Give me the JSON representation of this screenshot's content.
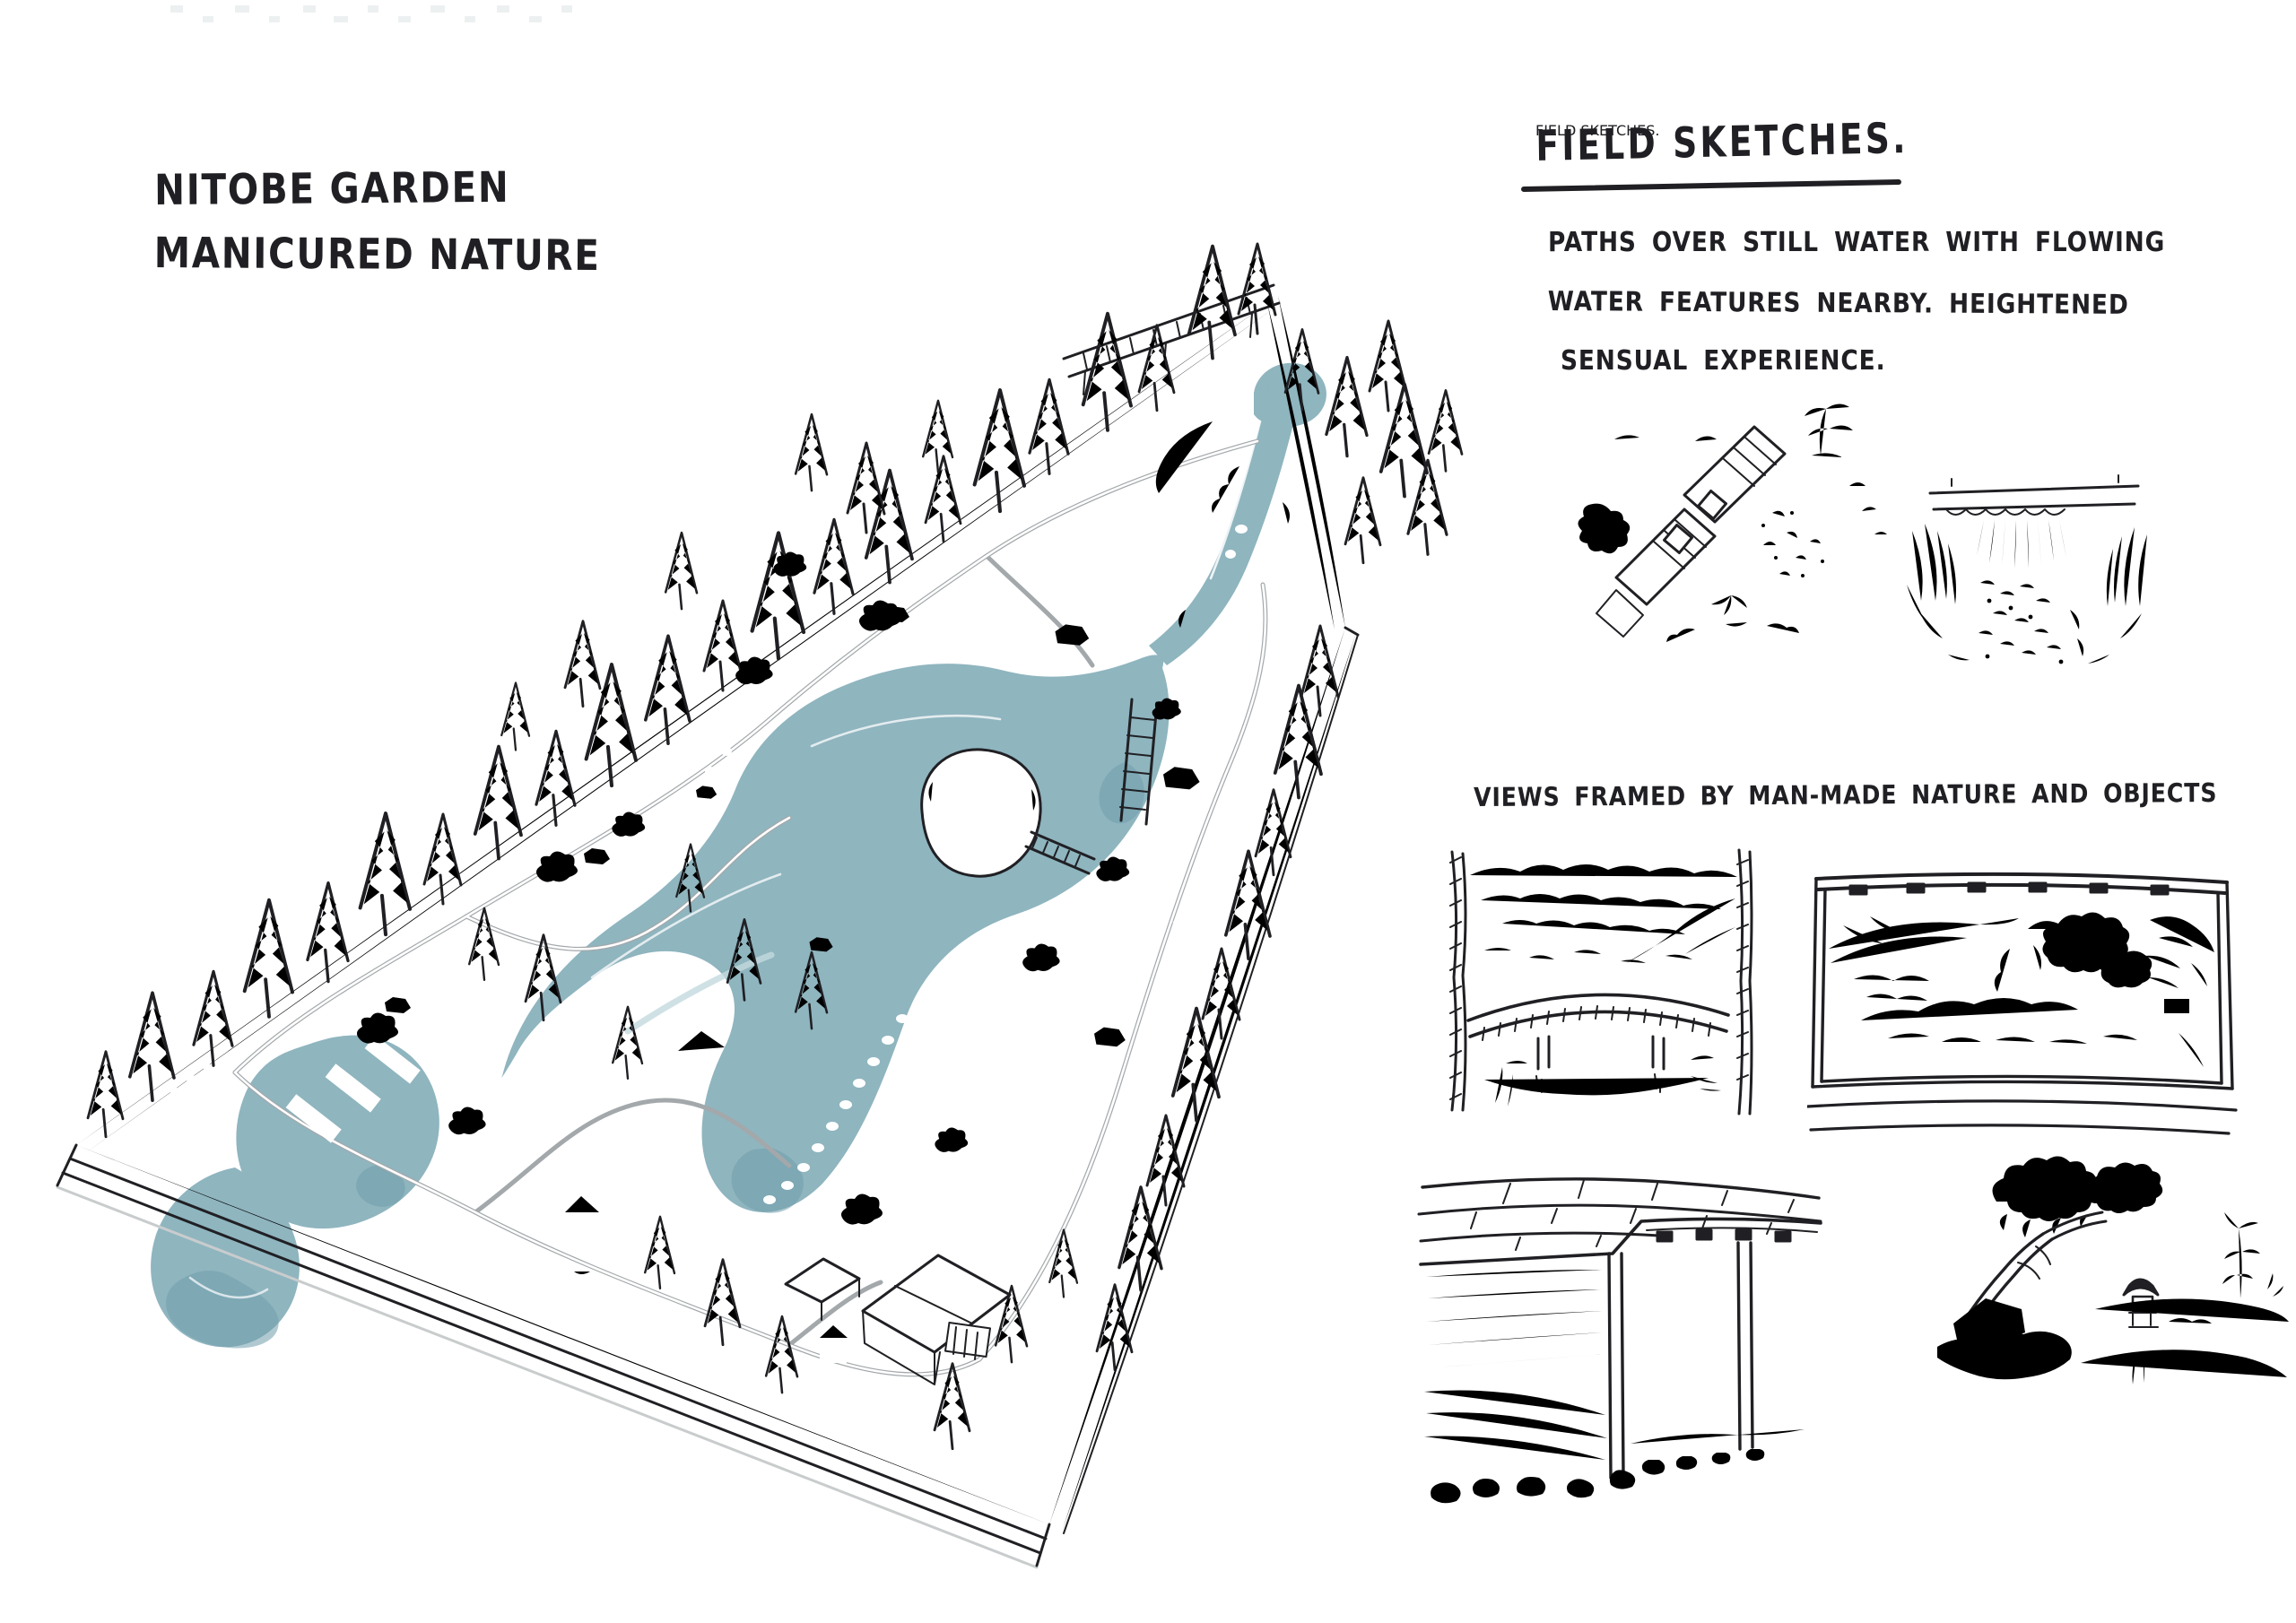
{
  "colors": {
    "paper": "#ffffff",
    "ink": "#202024",
    "path_gray": "#a3a8ab",
    "water_mid": "#8fb5bf",
    "water_light": "#c3d9de",
    "water_dark": "#6f9dab"
  },
  "plan": {
    "title_line1": "NITOBE GARDEN",
    "title_line2": "MANICURED NATURE"
  },
  "field_sketches": {
    "heading": "FIELD SKETCHES.",
    "note_lines": [
      "PATHS OVER STILL WATER WITH FLOWING",
      "WATER FEATURES NEARBY. HEIGHTENED",
      "SENSUAL EXPERIENCE."
    ]
  },
  "framed_views": {
    "caption": "VIEWS FRAMED BY MAN-MADE NATURE AND OBJECTS"
  }
}
